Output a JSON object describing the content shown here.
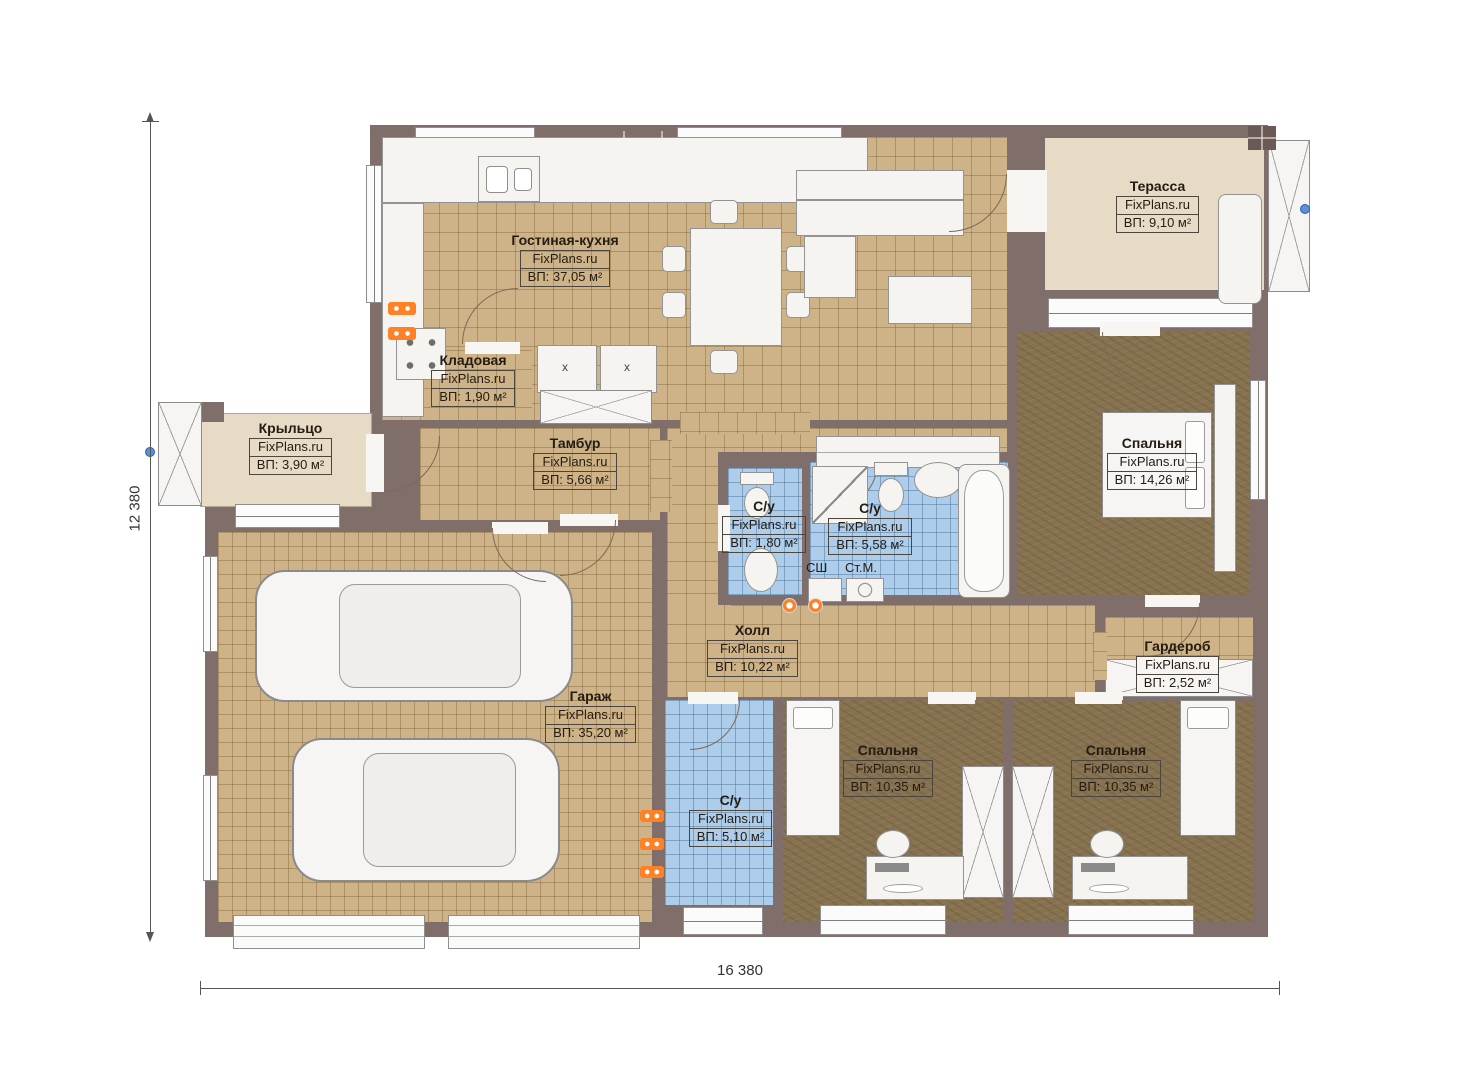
{
  "plan": {
    "watermark": "FixPlans.ru",
    "rooms": [
      {
        "name": "Гостиная-кухня",
        "area": "ВП: 37,05 м²"
      },
      {
        "name": "Терасса",
        "area": "ВП: 9,10 м²"
      },
      {
        "name": "Кладовая",
        "area": "ВП: 1,90 м²"
      },
      {
        "name": "Крыльцо",
        "area": "ВП: 3,90 м²"
      },
      {
        "name": "Тамбур",
        "area": "ВП: 5,66 м²"
      },
      {
        "name": "С/у",
        "area": "ВП: 1,80 м²"
      },
      {
        "name": "С/у",
        "area": "ВП: 5,58 м²"
      },
      {
        "name": "Спальня",
        "area": "ВП: 14,26 м²"
      },
      {
        "name": "Холл",
        "area": "ВП: 10,22 м²"
      },
      {
        "name": "Гардероб",
        "area": "ВП: 2,52 м²"
      },
      {
        "name": "Гараж",
        "area": "ВП: 35,20 м²"
      },
      {
        "name": "С/у",
        "area": "ВП: 5,10 м²"
      },
      {
        "name": "Спальня",
        "area": "ВП: 10,35 м²"
      },
      {
        "name": "Спальня",
        "area": "ВП: 10,35 м²"
      }
    ],
    "appliances": {
      "drying_cabinet": "СШ",
      "washing_machine": "Ст.М."
    },
    "cabinet_mark": "x",
    "dimensions": {
      "horizontal": "16 380",
      "vertical": "12 380"
    },
    "colors": {
      "wall": "#806e6b",
      "tile_beige": "#cdb387",
      "tile_blue": "#aecdea",
      "floor_bedroom": "#877250",
      "outdoor": "#e8dbc5",
      "radiator": "#ff8126",
      "handle_dot": "#5b8fd6"
    }
  }
}
